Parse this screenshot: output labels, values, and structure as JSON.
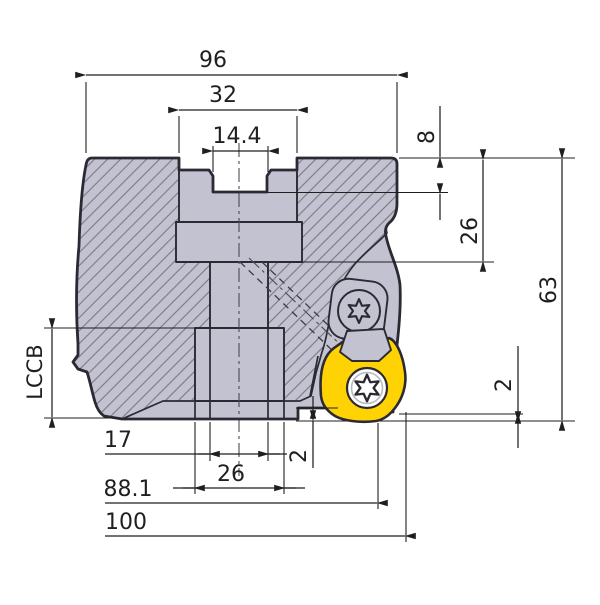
{
  "drawing": {
    "title": "face-mill-cutter-cross-section",
    "dimensions": {
      "overall_width": "96",
      "slot_width": "32",
      "keyway_width": "14.4",
      "keyway_depth": "8",
      "counterbore_depth": "26",
      "overall_height": "63",
      "insert_protrusion_side": "2",
      "insert_protrusion_bottom": "2",
      "bore_width": "17",
      "hub_width": "26",
      "tip_diameter": "88.1",
      "cutting_diameter": "100",
      "body_length_label": "LCCB"
    },
    "colors": {
      "body": "#c3c2d0",
      "insert": "#ffd303",
      "outline": "#2b2a33",
      "dim": "#1f1f1f",
      "hatch": "#6f6d7b",
      "background": "#ffffff"
    }
  }
}
